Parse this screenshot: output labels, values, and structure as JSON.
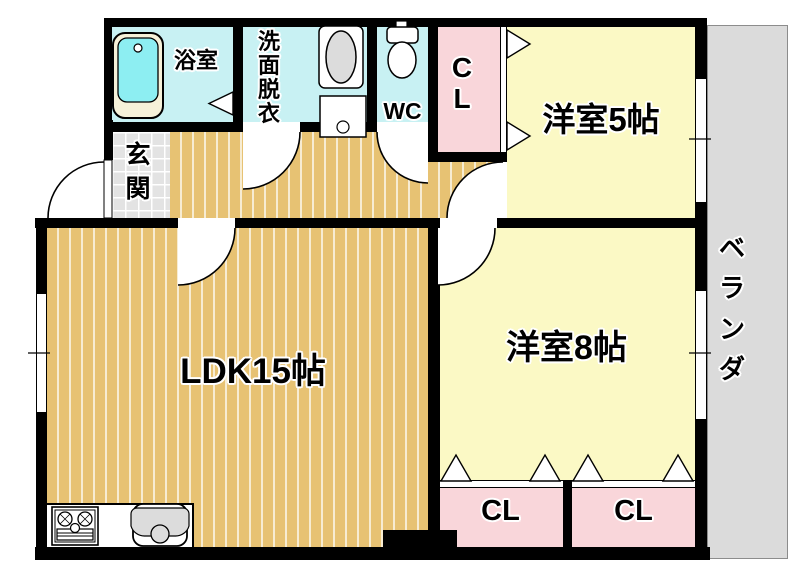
{
  "plan": {
    "rooms": {
      "bathroom": "浴室",
      "washroom": "洗面脱衣",
      "wc": "WC",
      "closet_top": "CL",
      "western_room_5": "洋室5帖",
      "entrance": "玄関",
      "ldk": "LDK15帖",
      "western_room_8": "洋室8帖",
      "closet_bottom_left": "CL",
      "closet_bottom_right": "CL",
      "veranda": "ベランダ"
    },
    "colors": {
      "wet_rooms": "#c8f1f3",
      "closets": "#f9d6da",
      "western_rooms": "#fbf9c5",
      "wood_flooring": "#e7c273",
      "entrance_tile": "#e3e3e3",
      "veranda": "#dbdbdb",
      "walls": "#000000"
    }
  }
}
